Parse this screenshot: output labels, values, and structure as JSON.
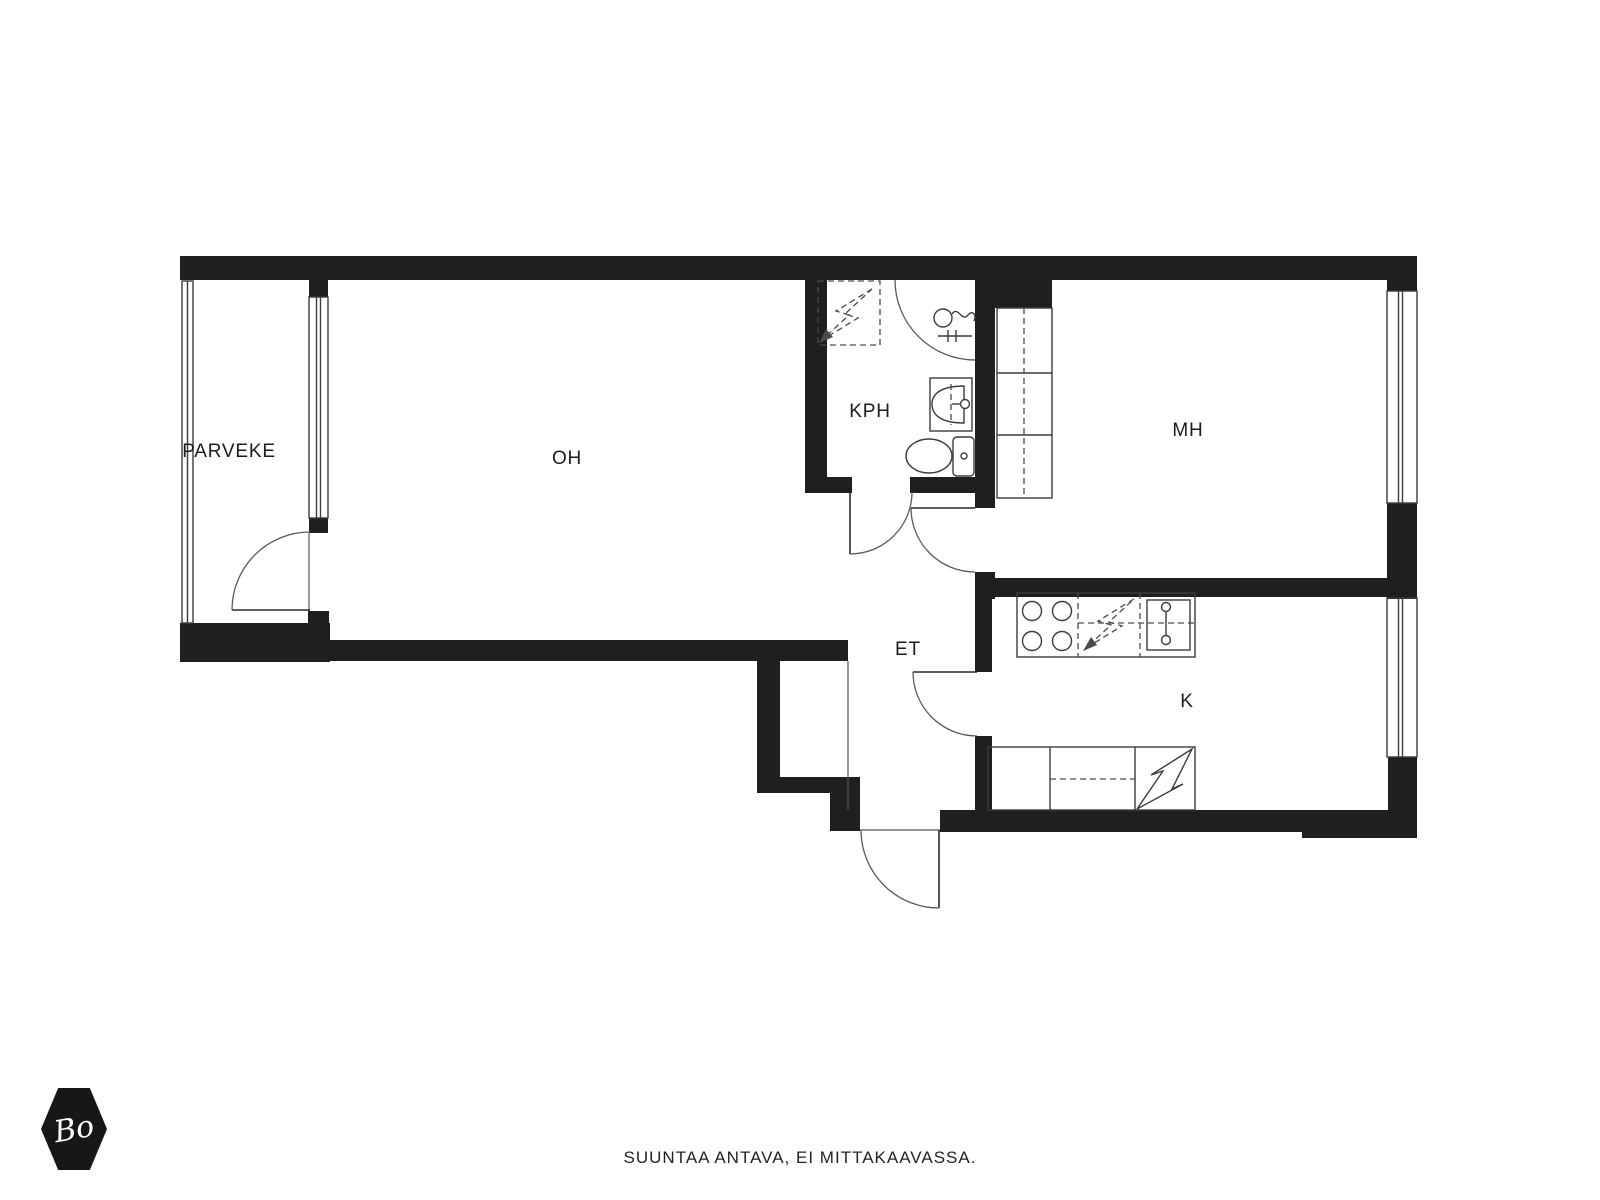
{
  "floor_plan": {
    "rooms": [
      {
        "id": "parveke",
        "label": "PARVEKE"
      },
      {
        "id": "oh",
        "label": "OH"
      },
      {
        "id": "kph",
        "label": "KPH"
      },
      {
        "id": "mh",
        "label": "MH"
      },
      {
        "id": "et",
        "label": "ET"
      },
      {
        "id": "k",
        "label": "K"
      }
    ],
    "fixtures": [
      "shower",
      "shower-mixer",
      "washbasin",
      "toilet",
      "washer-reservation",
      "wardrobe",
      "stove",
      "dishwasher-reservation",
      "kitchen-sink",
      "fridge-reservation",
      "kitchen-counter"
    ],
    "doors": [
      "balcony-door",
      "bathroom-door",
      "bedroom-door",
      "kitchen-door",
      "entrance-door"
    ],
    "footer_note": "SUUNTAA ANTAVA, EI MITTAKAAVASSA.",
    "logo_text": "Bo",
    "colors": {
      "wall": "#1f1f1f",
      "background": "#ffffff",
      "line": "#3c3c3c"
    }
  }
}
